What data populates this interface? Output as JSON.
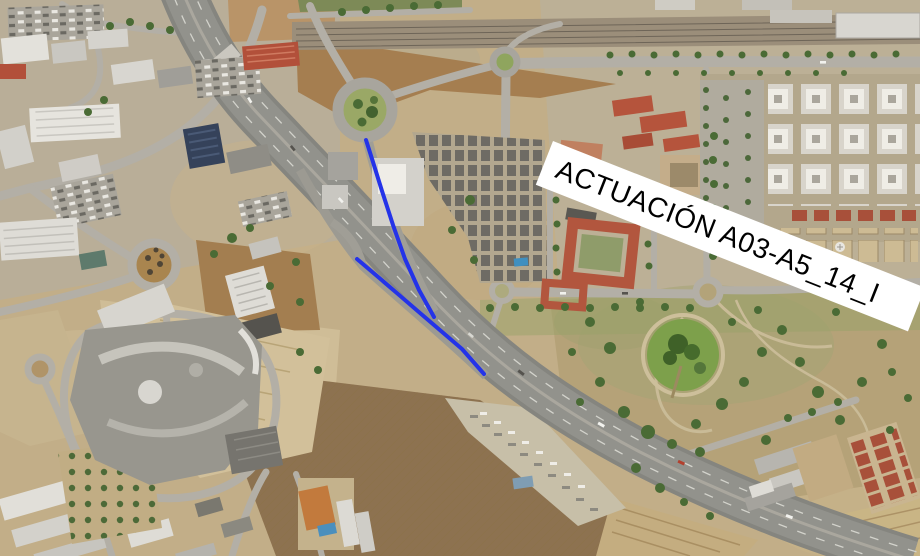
{
  "image": {
    "width": 920,
    "height": 556,
    "description": "Aerial orthophoto of a highway corridor between an industrial estate, a shopping centre, residential blocks and a park"
  },
  "annotation_label": {
    "text": "ACTUACIÓN A03-A5_14_I",
    "background_color": "#ffffff",
    "text_color": "#000000"
  },
  "highlight": {
    "color": "#2433e8",
    "stroke_width": "4",
    "lines": [
      {
        "name": "ramp-highlight",
        "points": "366,140 373,162 382,191 393,225 405,259 419,290 434,317"
      },
      {
        "name": "mainline-highlight",
        "points": "357,259 377,276 398,294 420,313 441,331 462,349 484,374"
      }
    ]
  }
}
